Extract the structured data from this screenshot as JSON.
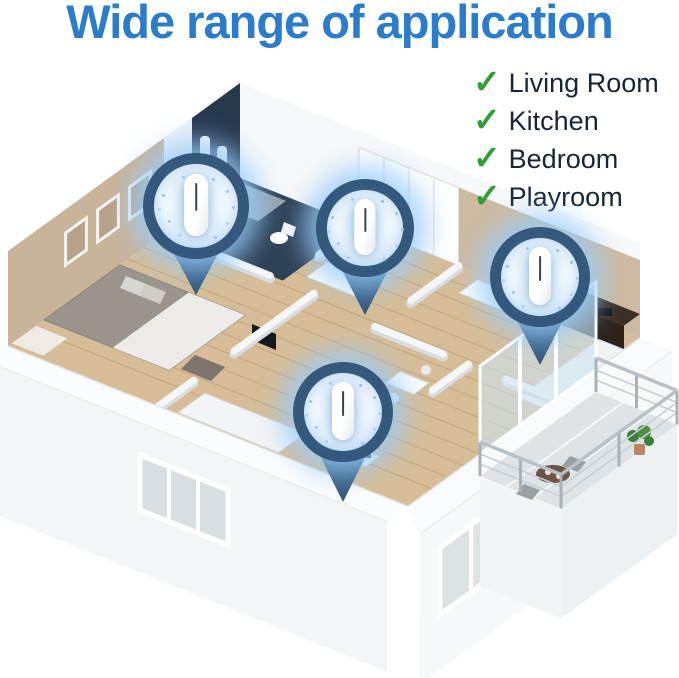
{
  "title": {
    "text": "Wide range of application"
  },
  "checklist": {
    "check_glyph": "✓",
    "items": [
      {
        "label": "Living Room"
      },
      {
        "label": "Kitchen"
      },
      {
        "label": "Bedroom"
      },
      {
        "label": "Playroom"
      }
    ]
  },
  "colors": {
    "title_blue": "#2b7ccb",
    "check_green": "#2f9e33",
    "checklist_text": "#16263a",
    "pin_navy": "#35597d",
    "glow_blue": "rgba(150,205,250,0.85)"
  },
  "icons": {
    "checkmark": "check-icon",
    "location_pin": "location-pin-icon",
    "device": "air-purifier-device"
  }
}
